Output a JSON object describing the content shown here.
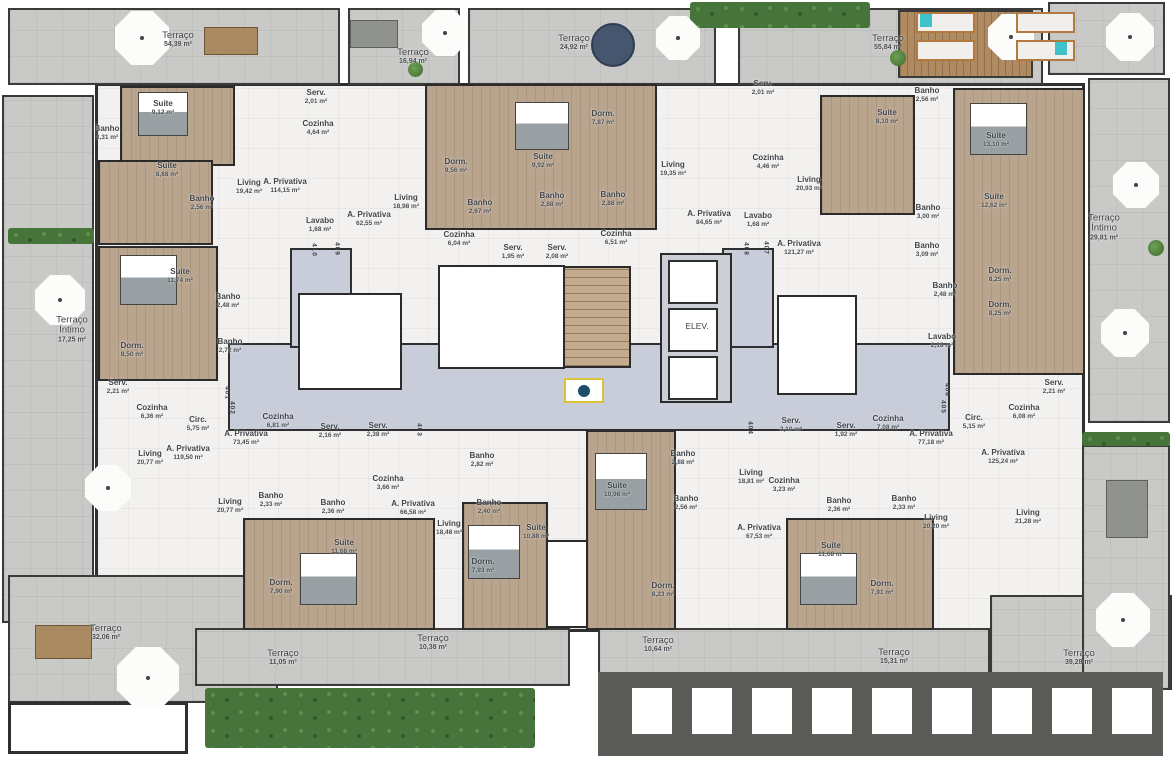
{
  "title": "Planta do pavimento tipo - unidades 401 a 410",
  "core": {
    "elevator_label": "ELEV."
  },
  "colors": {
    "wall": "#2f2f2f",
    "terrace": "#c9c9c7",
    "interior": "#f2f1ef",
    "wood": "#b9a48e",
    "corridor": "#c9cdd9",
    "roof": "#5b5c58",
    "hedge": "#47743a",
    "accent_teal": "#3fc2c9",
    "marker_yellow": "#d8c23a"
  },
  "rooms": [
    {
      "label": "Terraço",
      "area": "54,39 m²",
      "x": 178,
      "y": 40,
      "big": true
    },
    {
      "label": "Terraço",
      "area": "16,94 m²",
      "x": 413,
      "y": 57,
      "big": true
    },
    {
      "label": "Terraço",
      "area": "24,92 m²",
      "x": 574,
      "y": 43,
      "big": true
    },
    {
      "label": "Terraço",
      "area": "55,84 m²",
      "x": 888,
      "y": 43,
      "big": true
    },
    {
      "label": "Terraço Íntimo",
      "area": "17,25 m²",
      "x": 72,
      "y": 330,
      "big": true,
      "wrap": true
    },
    {
      "label": "Terraço Íntimo",
      "area": "29,81 m²",
      "x": 1104,
      "y": 228,
      "big": true,
      "wrap": true
    },
    {
      "label": "Terraço",
      "area": "32,06 m²",
      "x": 106,
      "y": 633,
      "big": true
    },
    {
      "label": "Terraço",
      "area": "11,05 m²",
      "x": 283,
      "y": 658,
      "big": true
    },
    {
      "label": "Terraço",
      "area": "10,38 m²",
      "x": 433,
      "y": 643,
      "big": true
    },
    {
      "label": "Terraço",
      "area": "10,64 m²",
      "x": 658,
      "y": 645,
      "big": true
    },
    {
      "label": "Terraço",
      "area": "15,31 m²",
      "x": 894,
      "y": 657,
      "big": true
    },
    {
      "label": "Terraço",
      "area": "39,28 m²",
      "x": 1079,
      "y": 658,
      "big": true
    },
    {
      "label": "Serv.",
      "area": "2,01 m²",
      "x": 316,
      "y": 97
    },
    {
      "label": "Cozinha",
      "area": "4,64 m²",
      "x": 318,
      "y": 128
    },
    {
      "label": "Suite",
      "area": "9,12 m²",
      "x": 163,
      "y": 108
    },
    {
      "label": "Banho",
      "area": "3,31 m²",
      "x": 107,
      "y": 133
    },
    {
      "label": "Suite",
      "area": "8,68 m²",
      "x": 167,
      "y": 170
    },
    {
      "label": "Banho",
      "area": "2,56 m²",
      "x": 202,
      "y": 203
    },
    {
      "label": "Living",
      "area": "19,42 m²",
      "x": 249,
      "y": 187
    },
    {
      "label": "A. Privativa",
      "area": "114,15 m²",
      "x": 285,
      "y": 186
    },
    {
      "label": "Suite",
      "area": "11,74 m²",
      "x": 180,
      "y": 276
    },
    {
      "label": "Banho",
      "area": "2,48 m²",
      "x": 228,
      "y": 301
    },
    {
      "label": "Banho",
      "area": "2,72 m²",
      "x": 230,
      "y": 346
    },
    {
      "label": "Dorm.",
      "area": "8,50 m²",
      "x": 132,
      "y": 350
    },
    {
      "label": "Serv.",
      "area": "2,21 m²",
      "x": 118,
      "y": 387
    },
    {
      "label": "Cozinha",
      "area": "6,36 m²",
      "x": 152,
      "y": 412
    },
    {
      "label": "Circ.",
      "area": "5,75 m²",
      "x": 198,
      "y": 424
    },
    {
      "label": "A. Privativa",
      "area": "119,50 m²",
      "x": 188,
      "y": 453
    },
    {
      "label": "Living",
      "area": "20,77 m²",
      "x": 150,
      "y": 458
    },
    {
      "label": "Cozinha",
      "area": "6,81 m²",
      "x": 278,
      "y": 421
    },
    {
      "label": "A. Privativa",
      "area": "73,45 m²",
      "x": 246,
      "y": 438
    },
    {
      "label": "Living",
      "area": "20,77 m²",
      "x": 230,
      "y": 506
    },
    {
      "label": "Banho",
      "area": "2,33 m²",
      "x": 271,
      "y": 500
    },
    {
      "label": "Banho",
      "area": "2,36 m²",
      "x": 333,
      "y": 507
    },
    {
      "label": "Suite",
      "area": "11,68 m²",
      "x": 344,
      "y": 547
    },
    {
      "label": "Dorm.",
      "area": "7,90 m²",
      "x": 281,
      "y": 587
    },
    {
      "label": "Serv.",
      "area": "2,16 m²",
      "x": 330,
      "y": 431
    },
    {
      "label": "Serv.",
      "area": "2,38 m²",
      "x": 378,
      "y": 430
    },
    {
      "label": "Cozinha",
      "area": "3,66 m²",
      "x": 388,
      "y": 483
    },
    {
      "label": "A. Privativa",
      "area": "66,58 m²",
      "x": 413,
      "y": 508
    },
    {
      "label": "Living",
      "area": "18,48 m²",
      "x": 449,
      "y": 528
    },
    {
      "label": "Banho",
      "area": "2,82 m²",
      "x": 482,
      "y": 460
    },
    {
      "label": "Banho",
      "area": "2,40 m²",
      "x": 489,
      "y": 507
    },
    {
      "label": "Suite",
      "area": "10,88 m²",
      "x": 536,
      "y": 532
    },
    {
      "label": "Dorm.",
      "area": "7,93 m²",
      "x": 483,
      "y": 566
    },
    {
      "label": "Banho",
      "area": "2,88 m²",
      "x": 683,
      "y": 458
    },
    {
      "label": "Banho",
      "area": "2,56 m²",
      "x": 686,
      "y": 503
    },
    {
      "label": "Suite",
      "area": "10,98 m²",
      "x": 617,
      "y": 490
    },
    {
      "label": "Dorm.",
      "area": "8,23 m²",
      "x": 663,
      "y": 590
    },
    {
      "label": "Living",
      "area": "18,81 m²",
      "x": 751,
      "y": 477
    },
    {
      "label": "Cozinha",
      "area": "3,23 m²",
      "x": 784,
      "y": 485
    },
    {
      "label": "A. Privativa",
      "area": "67,53 m²",
      "x": 759,
      "y": 532
    },
    {
      "label": "Serv.",
      "area": "2,10 m²",
      "x": 791,
      "y": 425
    },
    {
      "label": "Serv.",
      "area": "1,92 m²",
      "x": 846,
      "y": 430
    },
    {
      "label": "Cozinha",
      "area": "7,08 m²",
      "x": 888,
      "y": 423
    },
    {
      "label": "A. Privativa",
      "area": "77,18 m²",
      "x": 931,
      "y": 438
    },
    {
      "label": "Banho",
      "area": "2,36 m²",
      "x": 839,
      "y": 505
    },
    {
      "label": "Banho",
      "area": "2,33 m²",
      "x": 904,
      "y": 503
    },
    {
      "label": "Suite",
      "area": "11,68 m²",
      "x": 831,
      "y": 550
    },
    {
      "label": "Dorm.",
      "area": "7,91 m²",
      "x": 882,
      "y": 588
    },
    {
      "label": "Living",
      "area": "20,20 m²",
      "x": 936,
      "y": 522
    },
    {
      "label": "Circ.",
      "area": "5,15 m²",
      "x": 974,
      "y": 422
    },
    {
      "label": "Cozinha",
      "area": "6,08 m²",
      "x": 1024,
      "y": 412
    },
    {
      "label": "Serv.",
      "area": "2,21 m²",
      "x": 1054,
      "y": 387
    },
    {
      "label": "A. Privativa",
      "area": "125,24 m²",
      "x": 1003,
      "y": 457
    },
    {
      "label": "Living",
      "area": "21,28 m²",
      "x": 1028,
      "y": 517
    },
    {
      "label": "Serv.",
      "area": "2,01 m²",
      "x": 763,
      "y": 88
    },
    {
      "label": "Cozinha",
      "area": "4,46 m²",
      "x": 768,
      "y": 162
    },
    {
      "label": "Living",
      "area": "20,93 m²",
      "x": 809,
      "y": 184
    },
    {
      "label": "A. Privativa",
      "area": "121,27 m²",
      "x": 799,
      "y": 248
    },
    {
      "label": "Lavabo",
      "area": "1,68 m²",
      "x": 758,
      "y": 220
    },
    {
      "label": "Suite",
      "area": "8,10 m²",
      "x": 887,
      "y": 117
    },
    {
      "label": "Banho",
      "area": "2,56 m²",
      "x": 927,
      "y": 95
    },
    {
      "label": "Suite",
      "area": "13,10 m²",
      "x": 996,
      "y": 140
    },
    {
      "label": "Suite",
      "area": "12,62 m²",
      "x": 994,
      "y": 201
    },
    {
      "label": "Banho",
      "area": "3,00 m²",
      "x": 928,
      "y": 212
    },
    {
      "label": "Banho",
      "area": "3,09 m²",
      "x": 927,
      "y": 250
    },
    {
      "label": "Banho",
      "area": "2,48 m²",
      "x": 945,
      "y": 290
    },
    {
      "label": "Dorm.",
      "area": "8,25 m²",
      "x": 1000,
      "y": 275
    },
    {
      "label": "Dorm.",
      "area": "8,25 m²",
      "x": 1000,
      "y": 309
    },
    {
      "label": "Lavabo",
      "area": "2,18 m²",
      "x": 942,
      "y": 341
    },
    {
      "label": "Living",
      "area": "18,98 m²",
      "x": 406,
      "y": 202
    },
    {
      "label": "A. Privativa",
      "area": "62,55 m²",
      "x": 369,
      "y": 219
    },
    {
      "label": "Lavabo",
      "area": "1,68 m²",
      "x": 320,
      "y": 225
    },
    {
      "label": "Dorm.",
      "area": "9,56 m²",
      "x": 456,
      "y": 166
    },
    {
      "label": "Banho",
      "area": "2,67 m²",
      "x": 480,
      "y": 207
    },
    {
      "label": "Cozinha",
      "area": "6,04 m²",
      "x": 459,
      "y": 239
    },
    {
      "label": "Serv.",
      "area": "1,95 m²",
      "x": 513,
      "y": 252
    },
    {
      "label": "Suite",
      "area": "9,92 m²",
      "x": 543,
      "y": 161
    },
    {
      "label": "Banho",
      "area": "2,88 m²",
      "x": 552,
      "y": 200
    },
    {
      "label": "Banho",
      "area": "2,88 m²",
      "x": 613,
      "y": 199
    },
    {
      "label": "Dorm.",
      "area": "7,87 m²",
      "x": 603,
      "y": 118
    },
    {
      "label": "Living",
      "area": "19,35 m²",
      "x": 673,
      "y": 169
    },
    {
      "label": "Cozinha",
      "area": "6,51 m²",
      "x": 616,
      "y": 238
    },
    {
      "label": "Serv.",
      "area": "2,08 m²",
      "x": 557,
      "y": 252
    },
    {
      "label": "A. Privativa",
      "area": "84,65 m²",
      "x": 709,
      "y": 218
    }
  ],
  "units": [
    {
      "number": "401",
      "x": 227,
      "y": 393
    },
    {
      "number": "402",
      "x": 232,
      "y": 408
    },
    {
      "number": "403",
      "x": 419,
      "y": 430
    },
    {
      "number": "404",
      "x": 750,
      "y": 428
    },
    {
      "number": "405",
      "x": 943,
      "y": 407
    },
    {
      "number": "406",
      "x": 947,
      "y": 390
    },
    {
      "number": "407",
      "x": 766,
      "y": 248
    },
    {
      "number": "408",
      "x": 746,
      "y": 249
    },
    {
      "number": "409",
      "x": 337,
      "y": 249
    },
    {
      "number": "410",
      "x": 314,
      "y": 250
    }
  ]
}
